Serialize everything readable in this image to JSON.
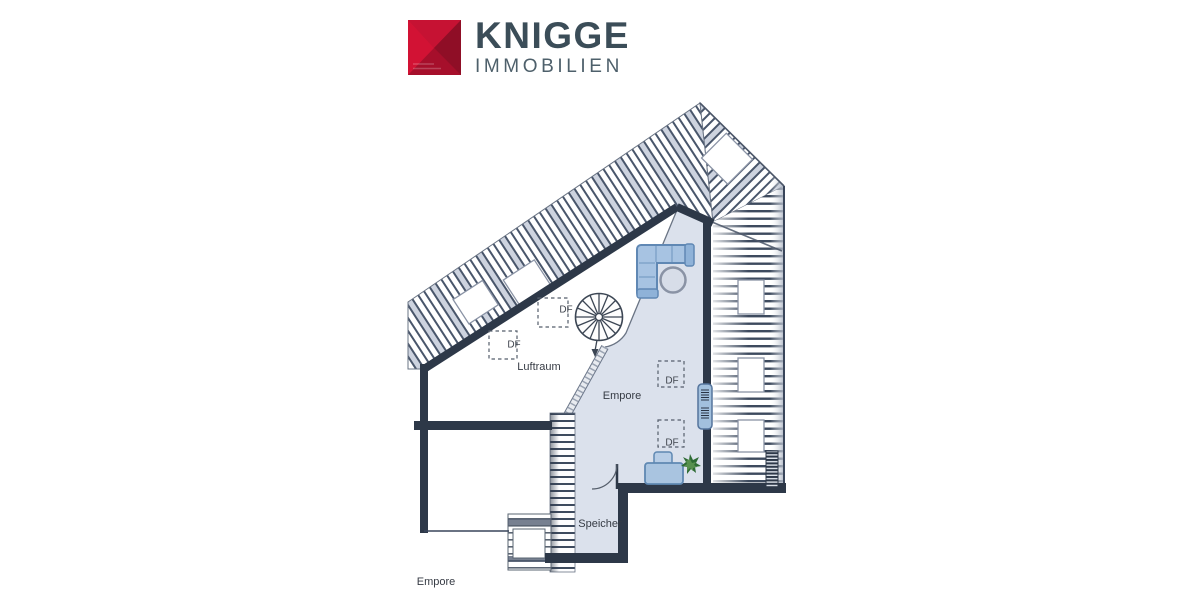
{
  "brand": {
    "name": "KNIGGE",
    "subtitle": "IMMOBILIEN"
  },
  "plan": {
    "labels": {
      "void": "Luftraum",
      "gallery": "Empore",
      "storage": "Speicher",
      "floor_title": "Empore"
    },
    "roof_windows": [
      {
        "label": "DF"
      },
      {
        "label": "DF"
      },
      {
        "label": "DF"
      },
      {
        "label": "DF"
      }
    ],
    "colors": {
      "wall": "#2d3848",
      "floor": "#dbe1ec",
      "furniture_blue": "#a7c3e2",
      "hatch_line": "#3d4a5e",
      "hatch_accent": "#cdd3df",
      "plant_green": "#2e6b34",
      "logo_red": "#b5122c",
      "logo_text": "#3b4d58",
      "logo_subtext": "#4e606b"
    }
  }
}
